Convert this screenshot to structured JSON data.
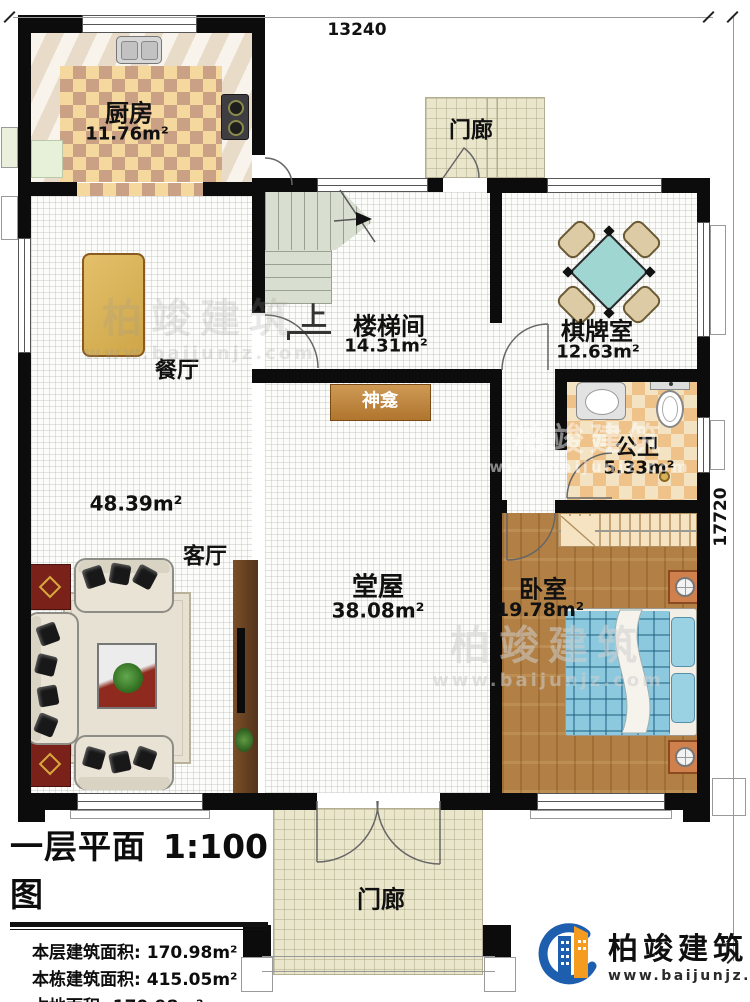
{
  "plan": {
    "dim_top": "13240",
    "dim_right": "17720"
  },
  "rooms": {
    "kitchen": {
      "name": "厨房",
      "area": "11.76m²"
    },
    "dining": {
      "name": "餐厅"
    },
    "living": {
      "name": "客厅",
      "area": "48.39m²"
    },
    "stair": {
      "name": "楼梯间",
      "area": "14.31m²",
      "up": "上"
    },
    "chess": {
      "name": "棋牌室",
      "area": "12.63m²"
    },
    "bath": {
      "name": "公卫",
      "area": "5.33m²"
    },
    "bedroom": {
      "name": "卧室",
      "area": "19.78m²"
    },
    "hall": {
      "name": "堂屋",
      "area": "38.08m²"
    },
    "shrine": {
      "name": "神龛"
    },
    "porch_top": {
      "name": "门廊"
    },
    "porch_bottom": {
      "name": "门廊"
    }
  },
  "legend": {
    "title": "一层平面图",
    "scale": "1:100",
    "stats": [
      {
        "label": "本层建筑面积:",
        "value": "170.98m²"
      },
      {
        "label": "本栋建筑面积:",
        "value": "415.05m²"
      },
      {
        "label": "占地面积:",
        "value": "170.98m²"
      },
      {
        "label": "层高:",
        "value": "3.6m"
      }
    ]
  },
  "brand": {
    "name": "柏竣建筑",
    "url": "www.baijunjz.com"
  },
  "watermark": {
    "name": "柏竣建筑",
    "url": "www.baijunjz.com"
  },
  "colors": {
    "brand_blue": "#1d5fae",
    "brand_orange": "#f59c20",
    "wall": "#0c0c0c"
  }
}
